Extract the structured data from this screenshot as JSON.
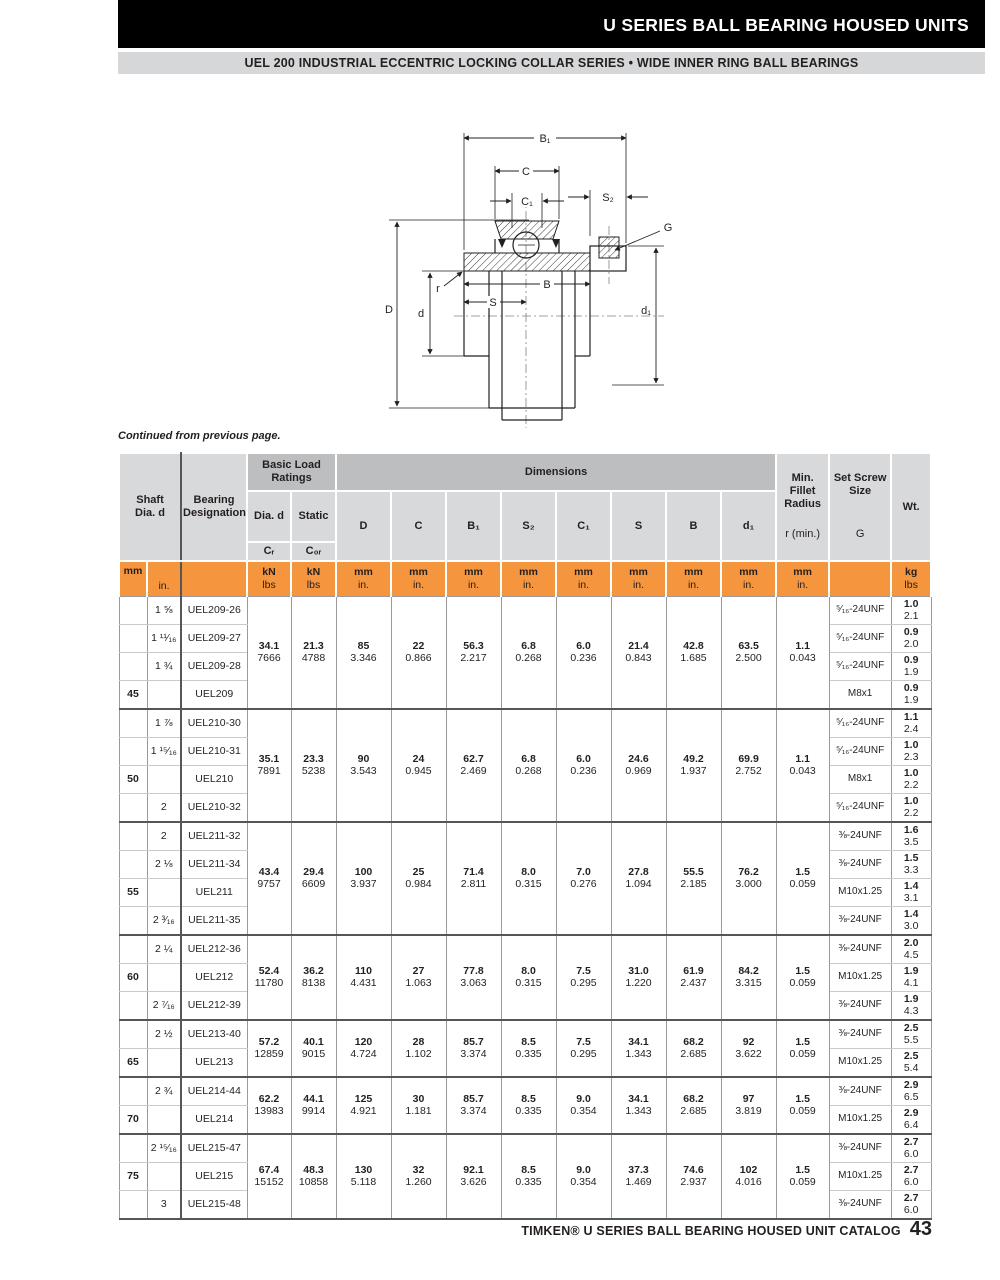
{
  "page": {
    "title_bar": "U SERIES BALL BEARING HOUSED UNITS",
    "subtitle_bar": "UEL 200 INDUSTRIAL ECCENTRIC LOCKING COLLAR SERIES • WIDE INNER RING BALL BEARINGS",
    "continued_note": "Continued from previous page.",
    "footer_text": "TIMKEN® U SERIES BALL BEARING HOUSED UNIT CATALOG",
    "footer_page": "43"
  },
  "drawing": {
    "labels": {
      "B1": "B₁",
      "C": "C",
      "C1": "C₁",
      "S2": "S₂",
      "G": "G",
      "D": "D",
      "d": "d",
      "r": "r",
      "S": "S",
      "B": "B",
      "d1": "d₁"
    }
  },
  "table": {
    "headers": {
      "shaft": "Shaft\nDia. d",
      "bearing": "Bearing\nDesignation",
      "basic_load": "Basic Load\nRatings",
      "dia_d": "Dia. d",
      "static_col": "Static",
      "cr": "Cᵣ",
      "c0r": "C₀ᵣ",
      "dimensions": "Dimensions",
      "dims": [
        "D",
        "C",
        "B₁",
        "S₂",
        "C₁",
        "S",
        "B",
        "d₁"
      ],
      "min_fillet": "Min.\nFillet\nRadius",
      "r_min": "r (min.)",
      "set_screw": "Set Screw\nSize",
      "g": "G",
      "wt": "Wt."
    },
    "units": {
      "mm": "mm",
      "in": "in.",
      "kn": "kN",
      "lbs": "lbs",
      "kg": "kg"
    },
    "groups": [
      {
        "mm": "45",
        "mm_row": 3,
        "merged": {
          "cr": [
            "34.1",
            "7666"
          ],
          "c0r": [
            "21.3",
            "4788"
          ],
          "D": [
            "85",
            "3.346"
          ],
          "C": [
            "22",
            "0.866"
          ],
          "B1": [
            "56.3",
            "2.217"
          ],
          "S2": [
            "6.8",
            "0.268"
          ],
          "C1": [
            "6.0",
            "0.236"
          ],
          "S": [
            "21.4",
            "0.843"
          ],
          "B": [
            "42.8",
            "1.685"
          ],
          "d1": [
            "63.5",
            "2.500"
          ],
          "r": [
            "1.1",
            "0.043"
          ]
        },
        "rows": [
          {
            "in": "1 ⅝",
            "desig": "UEL209-26",
            "screw": "⁵⁄₁₆-24UNF",
            "wt": [
              "1.0",
              "2.1"
            ]
          },
          {
            "in": "1 ¹¹⁄₁₆",
            "desig": "UEL209-27",
            "screw": "⁵⁄₁₆-24UNF",
            "wt": [
              "0.9",
              "2.0"
            ]
          },
          {
            "in": "1 ¾",
            "desig": "UEL209-28",
            "screw": "⁵⁄₁₆-24UNF",
            "wt": [
              "0.9",
              "1.9"
            ]
          },
          {
            "in": "",
            "desig": "UEL209",
            "screw": "M8x1",
            "wt": [
              "0.9",
              "1.9"
            ]
          }
        ]
      },
      {
        "mm": "50",
        "mm_row": 2,
        "merged": {
          "cr": [
            "35.1",
            "7891"
          ],
          "c0r": [
            "23.3",
            "5238"
          ],
          "D": [
            "90",
            "3.543"
          ],
          "C": [
            "24",
            "0.945"
          ],
          "B1": [
            "62.7",
            "2.469"
          ],
          "S2": [
            "6.8",
            "0.268"
          ],
          "C1": [
            "6.0",
            "0.236"
          ],
          "S": [
            "24.6",
            "0.969"
          ],
          "B": [
            "49.2",
            "1.937"
          ],
          "d1": [
            "69.9",
            "2.752"
          ],
          "r": [
            "1.1",
            "0.043"
          ]
        },
        "rows": [
          {
            "in": "1 ⅞",
            "desig": "UEL210-30",
            "screw": "⁵⁄₁₆-24UNF",
            "wt": [
              "1.1",
              "2.4"
            ]
          },
          {
            "in": "1 ¹⁵⁄₁₆",
            "desig": "UEL210-31",
            "screw": "⁵⁄₁₆-24UNF",
            "wt": [
              "1.0",
              "2.3"
            ]
          },
          {
            "in": "",
            "desig": "UEL210",
            "screw": "M8x1",
            "wt": [
              "1.0",
              "2.2"
            ]
          },
          {
            "in": "2",
            "desig": "UEL210-32",
            "screw": "⁵⁄₁₆-24UNF",
            "wt": [
              "1.0",
              "2.2"
            ]
          }
        ]
      },
      {
        "mm": "55",
        "mm_row": 2,
        "merged": {
          "cr": [
            "43.4",
            "9757"
          ],
          "c0r": [
            "29.4",
            "6609"
          ],
          "D": [
            "100",
            "3.937"
          ],
          "C": [
            "25",
            "0.984"
          ],
          "B1": [
            "71.4",
            "2.811"
          ],
          "S2": [
            "8.0",
            "0.315"
          ],
          "C1": [
            "7.0",
            "0.276"
          ],
          "S": [
            "27.8",
            "1.094"
          ],
          "B": [
            "55.5",
            "2.185"
          ],
          "d1": [
            "76.2",
            "3.000"
          ],
          "r": [
            "1.5",
            "0.059"
          ]
        },
        "rows": [
          {
            "in": "2",
            "desig": "UEL211-32",
            "screw": "⅜-24UNF",
            "wt": [
              "1.6",
              "3.5"
            ]
          },
          {
            "in": "2 ⅛",
            "desig": "UEL211-34",
            "screw": "⅜-24UNF",
            "wt": [
              "1.5",
              "3.3"
            ]
          },
          {
            "in": "",
            "desig": "UEL211",
            "screw": "M10x1.25",
            "wt": [
              "1.4",
              "3.1"
            ]
          },
          {
            "in": "2 ³⁄₁₆",
            "desig": "UEL211-35",
            "screw": "⅜-24UNF",
            "wt": [
              "1.4",
              "3.0"
            ]
          }
        ]
      },
      {
        "mm": "60",
        "mm_row": 1,
        "merged": {
          "cr": [
            "52.4",
            "11780"
          ],
          "c0r": [
            "36.2",
            "8138"
          ],
          "D": [
            "110",
            "4.431"
          ],
          "C": [
            "27",
            "1.063"
          ],
          "B1": [
            "77.8",
            "3.063"
          ],
          "S2": [
            "8.0",
            "0.315"
          ],
          "C1": [
            "7.5",
            "0.295"
          ],
          "S": [
            "31.0",
            "1.220"
          ],
          "B": [
            "61.9",
            "2.437"
          ],
          "d1": [
            "84.2",
            "3.315"
          ],
          "r": [
            "1.5",
            "0.059"
          ]
        },
        "rows": [
          {
            "in": "2 ¼",
            "desig": "UEL212-36",
            "screw": "⅜-24UNF",
            "wt": [
              "2.0",
              "4.5"
            ]
          },
          {
            "in": "",
            "desig": "UEL212",
            "screw": "M10x1.25",
            "wt": [
              "1.9",
              "4.1"
            ]
          },
          {
            "in": "2 ⁷⁄₁₆",
            "desig": "UEL212-39",
            "screw": "⅜-24UNF",
            "wt": [
              "1.9",
              "4.3"
            ]
          }
        ]
      },
      {
        "mm": "65",
        "mm_row": 1,
        "merged": {
          "cr": [
            "57.2",
            "12859"
          ],
          "c0r": [
            "40.1",
            "9015"
          ],
          "D": [
            "120",
            "4.724"
          ],
          "C": [
            "28",
            "1.102"
          ],
          "B1": [
            "85.7",
            "3.374"
          ],
          "S2": [
            "8.5",
            "0.335"
          ],
          "C1": [
            "7.5",
            "0.295"
          ],
          "S": [
            "34.1",
            "1.343"
          ],
          "B": [
            "68.2",
            "2.685"
          ],
          "d1": [
            "92",
            "3.622"
          ],
          "r": [
            "1.5",
            "0.059"
          ]
        },
        "rows": [
          {
            "in": "2 ½",
            "desig": "UEL213-40",
            "screw": "⅜-24UNF",
            "wt": [
              "2.5",
              "5.5"
            ]
          },
          {
            "in": "",
            "desig": "UEL213",
            "screw": "M10x1.25",
            "wt": [
              "2.5",
              "5.4"
            ]
          }
        ]
      },
      {
        "mm": "70",
        "mm_row": 1,
        "merged": {
          "cr": [
            "62.2",
            "13983"
          ],
          "c0r": [
            "44.1",
            "9914"
          ],
          "D": [
            "125",
            "4.921"
          ],
          "C": [
            "30",
            "1.181"
          ],
          "B1": [
            "85.7",
            "3.374"
          ],
          "S2": [
            "8.5",
            "0.335"
          ],
          "C1": [
            "9.0",
            "0.354"
          ],
          "S": [
            "34.1",
            "1.343"
          ],
          "B": [
            "68.2",
            "2.685"
          ],
          "d1": [
            "97",
            "3.819"
          ],
          "r": [
            "1.5",
            "0.059"
          ]
        },
        "rows": [
          {
            "in": "2 ¾",
            "desig": "UEL214-44",
            "screw": "⅜-24UNF",
            "wt": [
              "2.9",
              "6.5"
            ]
          },
          {
            "in": "",
            "desig": "UEL214",
            "screw": "M10x1.25",
            "wt": [
              "2.9",
              "6.4"
            ]
          }
        ]
      },
      {
        "mm": "75",
        "mm_row": 1,
        "merged": {
          "cr": [
            "67.4",
            "15152"
          ],
          "c0r": [
            "48.3",
            "10858"
          ],
          "D": [
            "130",
            "5.118"
          ],
          "C": [
            "32",
            "1.260"
          ],
          "B1": [
            "92.1",
            "3.626"
          ],
          "S2": [
            "8.5",
            "0.335"
          ],
          "C1": [
            "9.0",
            "0.354"
          ],
          "S": [
            "37.3",
            "1.469"
          ],
          "B": [
            "74.6",
            "2.937"
          ],
          "d1": [
            "102",
            "4.016"
          ],
          "r": [
            "1.5",
            "0.059"
          ]
        },
        "rows": [
          {
            "in": "2 ¹⁵⁄₁₆",
            "desig": "UEL215-47",
            "screw": "⅜-24UNF",
            "wt": [
              "2.7",
              "6.0"
            ]
          },
          {
            "in": "",
            "desig": "UEL215",
            "screw": "M10x1.25",
            "wt": [
              "2.7",
              "6.0"
            ]
          },
          {
            "in": "3",
            "desig": "UEL215-48",
            "screw": "⅜-24UNF",
            "wt": [
              "2.7",
              "6.0"
            ]
          }
        ]
      }
    ]
  }
}
